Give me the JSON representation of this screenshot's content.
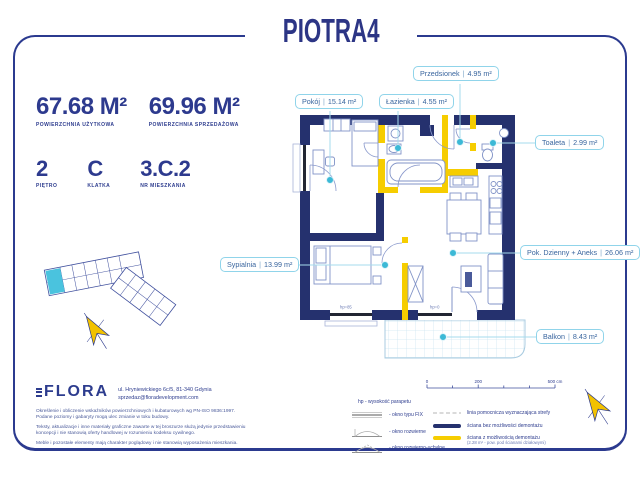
{
  "title": "PIOTRA4",
  "summary": {
    "areas": [
      {
        "value": "67.68",
        "unit": "M²",
        "label": "POWIERZCHNIA UŻYTKOWA"
      },
      {
        "value": "69.96",
        "unit": "M²",
        "label": "POWIERZCHNIA SPRZEDAŻOWA"
      }
    ],
    "attributes": [
      {
        "value": "2",
        "label": "PIĘTRO"
      },
      {
        "value": "C",
        "label": "KLATKA"
      },
      {
        "value": "3.C.2",
        "label": "NR MIESZKANIA"
      }
    ]
  },
  "plan": {
    "sep": "|",
    "rooms": [
      {
        "name": "Pokój",
        "area": "15.14 m²"
      },
      {
        "name": "Łazienka",
        "area": "4.55 m²"
      },
      {
        "name": "Przedsionek",
        "area": "4.95 m²"
      },
      {
        "name": "Toaleta",
        "area": "2.99 m²"
      },
      {
        "name": "Pok. Dzienny + Aneks",
        "area": "26.06 m²"
      },
      {
        "name": "Sypialnia",
        "area": "13.99 m²"
      },
      {
        "name": "Balkon",
        "area": "8.43 m²"
      }
    ],
    "window_notes": [
      "hp=85",
      "hp=0"
    ]
  },
  "scalebar": {
    "ticks": [
      "0",
      "200",
      "500 cm"
    ]
  },
  "legend": {
    "hp_note": "hp - wysokość parapetu",
    "left": [
      {
        "icon": "window-fix",
        "label": "- okno typu FIX"
      },
      {
        "icon": "window-casement",
        "label": "- okno rozwierne"
      },
      {
        "icon": "window-tilt",
        "label": "- okno rozwierno-uchylne"
      }
    ],
    "right": [
      {
        "icon": "dashed-line",
        "label": "linia pomocnicza wyznaczająca strefy"
      },
      {
        "icon": "navy-wall",
        "label": "ściana bez możliwości demontażu"
      },
      {
        "icon": "yellow-wall",
        "label": "ściana z możliwością demontażu",
        "note": "(2.28 m² - pow. pod ścianami działowymi)"
      }
    ]
  },
  "developer": {
    "name": "FLORA",
    "address": "ul. Hryniewickiego 6c/5, 81-340 Gdynia",
    "email": "sprzedaz@floradevelopment.com"
  },
  "disclaimers": [
    "Określenie i obliczenie wskaźników powierzchniowych i kubaturowych wg PN-ISO 9836:1997. Podane poziomy i gabaryty mogą ulec zmianie w toku budowy.",
    "Teksty, aktualizacje i inne materiały graficzne zawarte w tej broszurze służą jedynie przedstawieniu koncepcji i nie stanowią oferty handlowej w rozumieniu kodeksu cywilnego.",
    "Meble i pozostałe elementy mają charakter poglądowy i nie stanowią wyposażenia mieszkania."
  ],
  "colors": {
    "navy": "#25316e",
    "yellow": "#f6cd00",
    "cyan": "#3cb9d6",
    "label_border": "#90d4ea",
    "fixture": "#8193c7"
  }
}
